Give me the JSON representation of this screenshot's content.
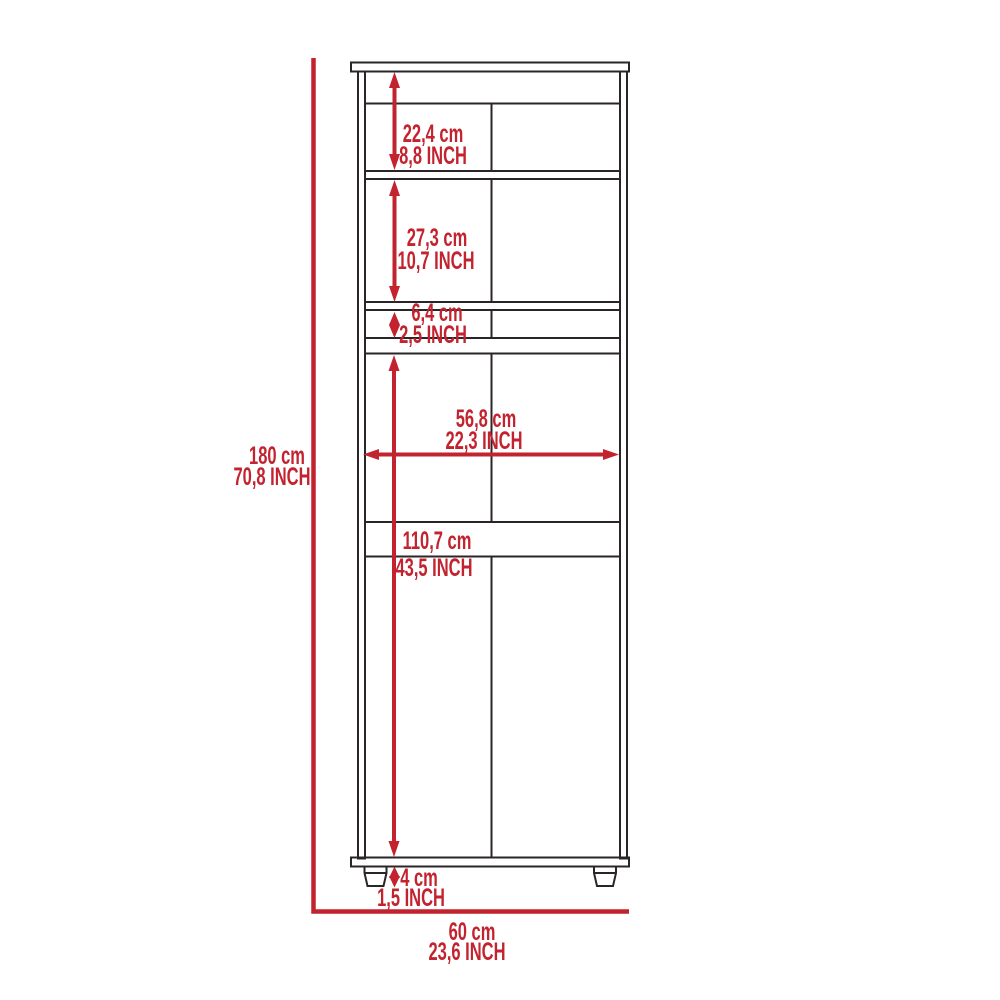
{
  "meta": {
    "title": "Cabinet dimension diagram",
    "view": "front elevation technical drawing",
    "units": [
      "cm",
      "INCH"
    ],
    "accent_color": "#C2232E",
    "line_color": "#2A2526",
    "background_color": "#FFFFFF"
  },
  "dims": {
    "total_height": {
      "cm": "180 cm",
      "inch": "70,8 INCH"
    },
    "total_width": {
      "cm": "60 cm",
      "inch": "23,6 INCH"
    },
    "top_compartment": {
      "cm": "22,4 cm",
      "inch": "8,8 INCH"
    },
    "upper_compartment": {
      "cm": "27,3 cm",
      "inch": "10,7 INCH"
    },
    "small_compartment": {
      "cm": "6,4 cm",
      "inch": "2,5 INCH"
    },
    "interior_width": {
      "cm": "56,8 cm",
      "inch": "22,3 INCH"
    },
    "lower_compartment": {
      "cm": "110,7 cm",
      "inch": "43,5 INCH"
    },
    "leg_height": {
      "cm": "4 cm",
      "inch": "1,5 INCH"
    }
  }
}
